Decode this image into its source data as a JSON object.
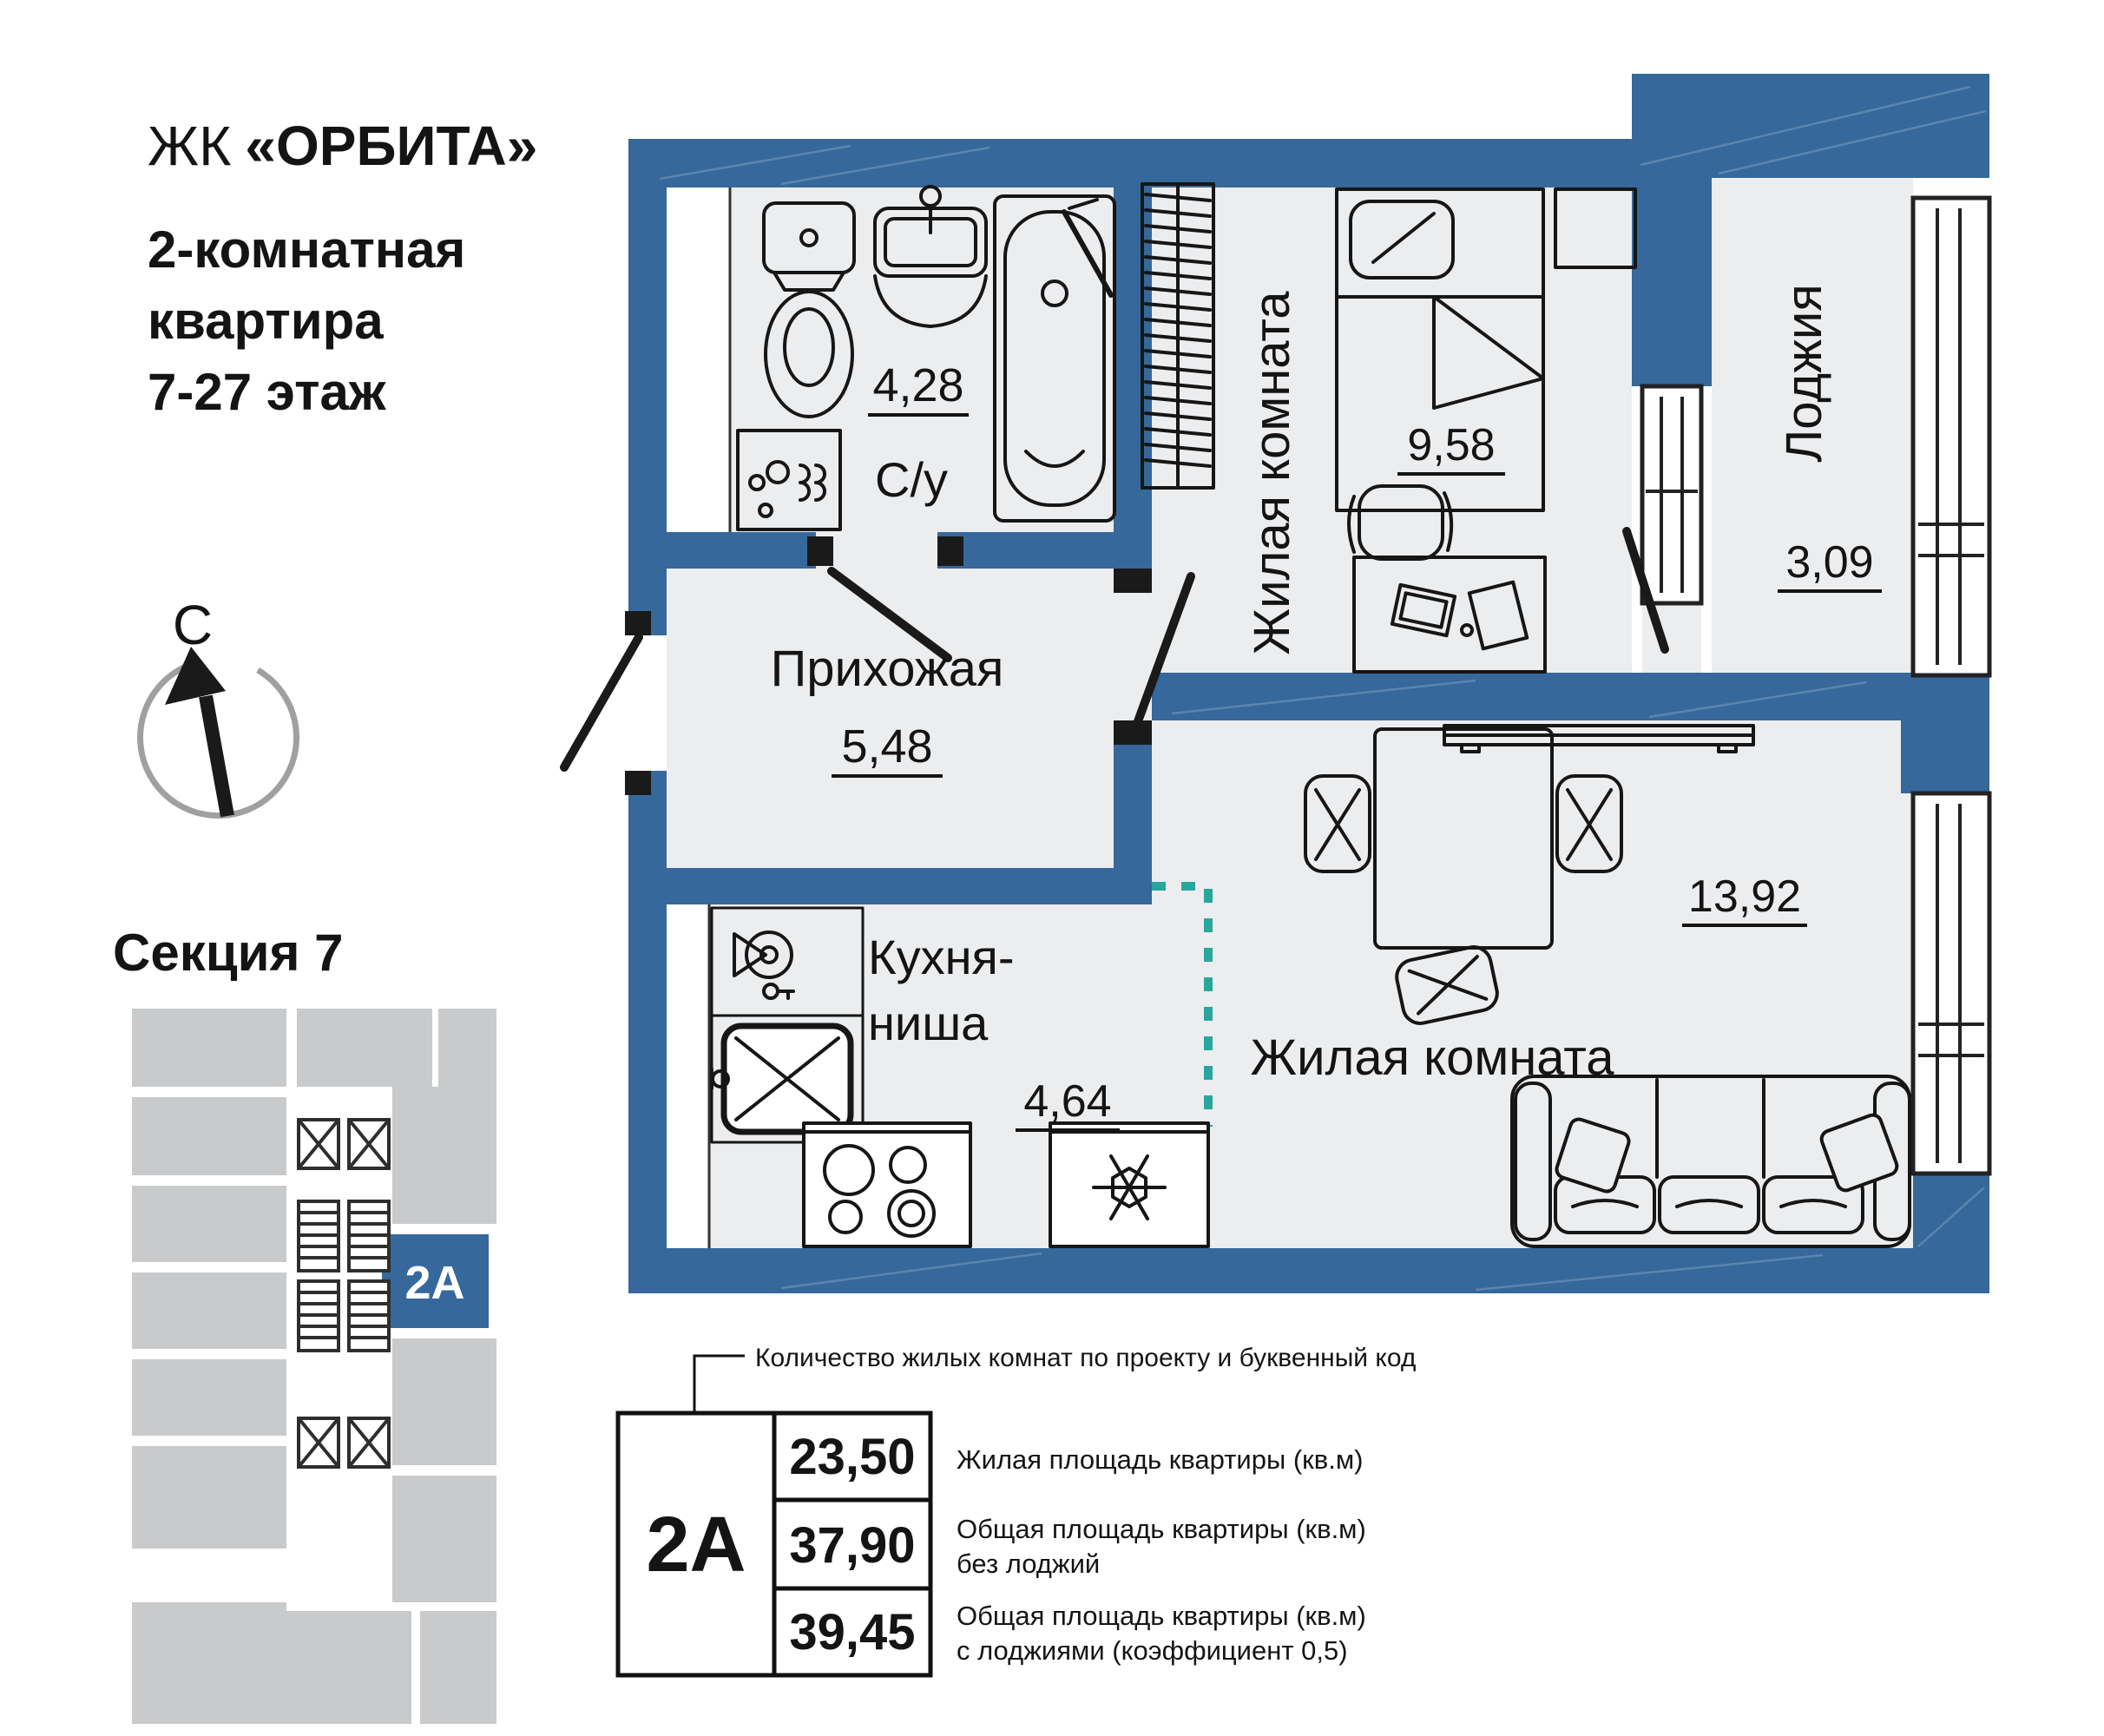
{
  "colors": {
    "wall": "#36689B",
    "floor": "#ECEDEF",
    "accent": "#36689B",
    "teal": "#29A69C",
    "mapgray": "#C8CACC",
    "ink": "#141414"
  },
  "header": {
    "prefix": "ЖК",
    "name": "«ОРБИТА»",
    "line1": "2-комнатная",
    "line2": "квартира",
    "line3": "7-27 этаж"
  },
  "compass": {
    "north": "С"
  },
  "section": {
    "title": "Секция 7",
    "unit": "2А"
  },
  "rooms": {
    "bathroom": {
      "label": "С/у",
      "area": "4,28"
    },
    "hallway": {
      "label": "Прихожая",
      "area": "5,48"
    },
    "bedroom": {
      "label": "Жилая комната",
      "area": "9,58"
    },
    "loggia": {
      "label": "Лоджия",
      "area": "3,09"
    },
    "kitchen": {
      "line1": "Кухня-",
      "line2": "ниша",
      "area": "4,64"
    },
    "living": {
      "label": "Жилая комната",
      "area": "13,92"
    }
  },
  "legend": {
    "note": "Количество жилых комнат по проекту и буквенный код",
    "code": "2А",
    "rows": [
      {
        "value": "23,50",
        "d1": "Жилая площадь квартиры (кв.м)",
        "d2": ""
      },
      {
        "value": "37,90",
        "d1": "Общая площадь квартиры (кв.м)",
        "d2": "без лоджий"
      },
      {
        "value": "39,45",
        "d1": "Общая площадь квартиры (кв.м)",
        "d2": "с лоджиями (коэффициент 0,5)"
      }
    ]
  }
}
